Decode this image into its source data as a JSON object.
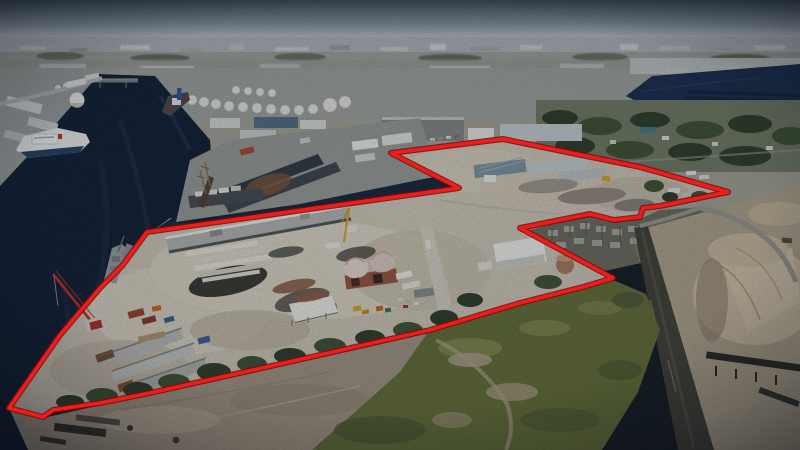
{
  "meta": {
    "description": "Aerial drone photograph of an industrial waterfront shipyard property outlined with a red property-boundary annotation; river and docked ships at left, electrical substation and sand aggregate yard at right, grass field and dirt in the foreground",
    "annotation": {
      "type": "property-boundary-outline",
      "style": "red-polygon"
    }
  },
  "boundary": {
    "points_px": "147,232 459,188 391,153 503,139 640,167 728,192 660,206 643,208 640,217 614,220 590,214 520,228 613,278 583,287 520,303 430,330 280,364 150,393 100,403 53,410 43,417 9,408 60,335 100,288 122,266"
  },
  "palette": {
    "sky_top": "#3e4e5c",
    "sky_horizon": "#c3cacf",
    "haze": "#b3bac0",
    "city_far": "#a2a8a4",
    "bank": "#9fa6a7",
    "water": "#16243c",
    "water_light": "#3a557a",
    "bay": "#1f3354",
    "pier": "#9aa09e",
    "drydock": "#b6bbb7",
    "drydock_dark": "#363e46",
    "parcel_ground": "#d2ccbe",
    "concrete_light": "#ded9cb",
    "asphalt": "#3e3e3a",
    "sand_fg": "#a59a8a",
    "sand_pile": "#ccbfa6",
    "aggregate": "#b3a894",
    "grass": "#68743f",
    "grass_light": "#8a9158",
    "scrub": "#55603f",
    "tree": "#32432f",
    "tree2": "#43573b",
    "road_dark": "#46463f",
    "road_light": "#9e9e96",
    "substation": "#6f7265",
    "steel": "#a8a8a4",
    "white_bldg": "#e9ebe8",
    "gray_roof": "#868b8d",
    "blue_roof": "#7e98a8",
    "pale_roof": "#c9d2d5",
    "arch_roof": "#e9dbd5",
    "arch_wall": "#9c5847",
    "container_red": "#9e4532",
    "container_blue": "#3c6596",
    "ship_white": "#eef1f1",
    "hull_blue": "#27466a",
    "navy_gray": "#9aa2a5",
    "tallship_hull": "#57433a",
    "machine_yellow": "#d8a827",
    "rust": "#7a5642",
    "crane_red": "#c23428",
    "boundary_red": "#ee1d1b",
    "boundary_shadow": "#7d0c0c"
  },
  "features": [
    "sky",
    "distant-city-skyline",
    "river-channel",
    "tidal-bay",
    "west-bank-port",
    "ferry-ship",
    "navy-ship",
    "tall-ship",
    "shipyard-pier",
    "floating-dry-dock",
    "tank-farm",
    "warehouse-district",
    "residential-tree-band",
    "southern-waterfront-parcel",
    "northern-parcel",
    "red-property-boundary",
    "mobile-red-crane",
    "arched-roof-warehouse",
    "white-canopy-structure",
    "storage-shed-rows",
    "shipping-containers",
    "electrical-substation",
    "haul-road",
    "aggregate-sand-piles",
    "conveyor-machine",
    "grass-field",
    "foreground-dirt"
  ]
}
